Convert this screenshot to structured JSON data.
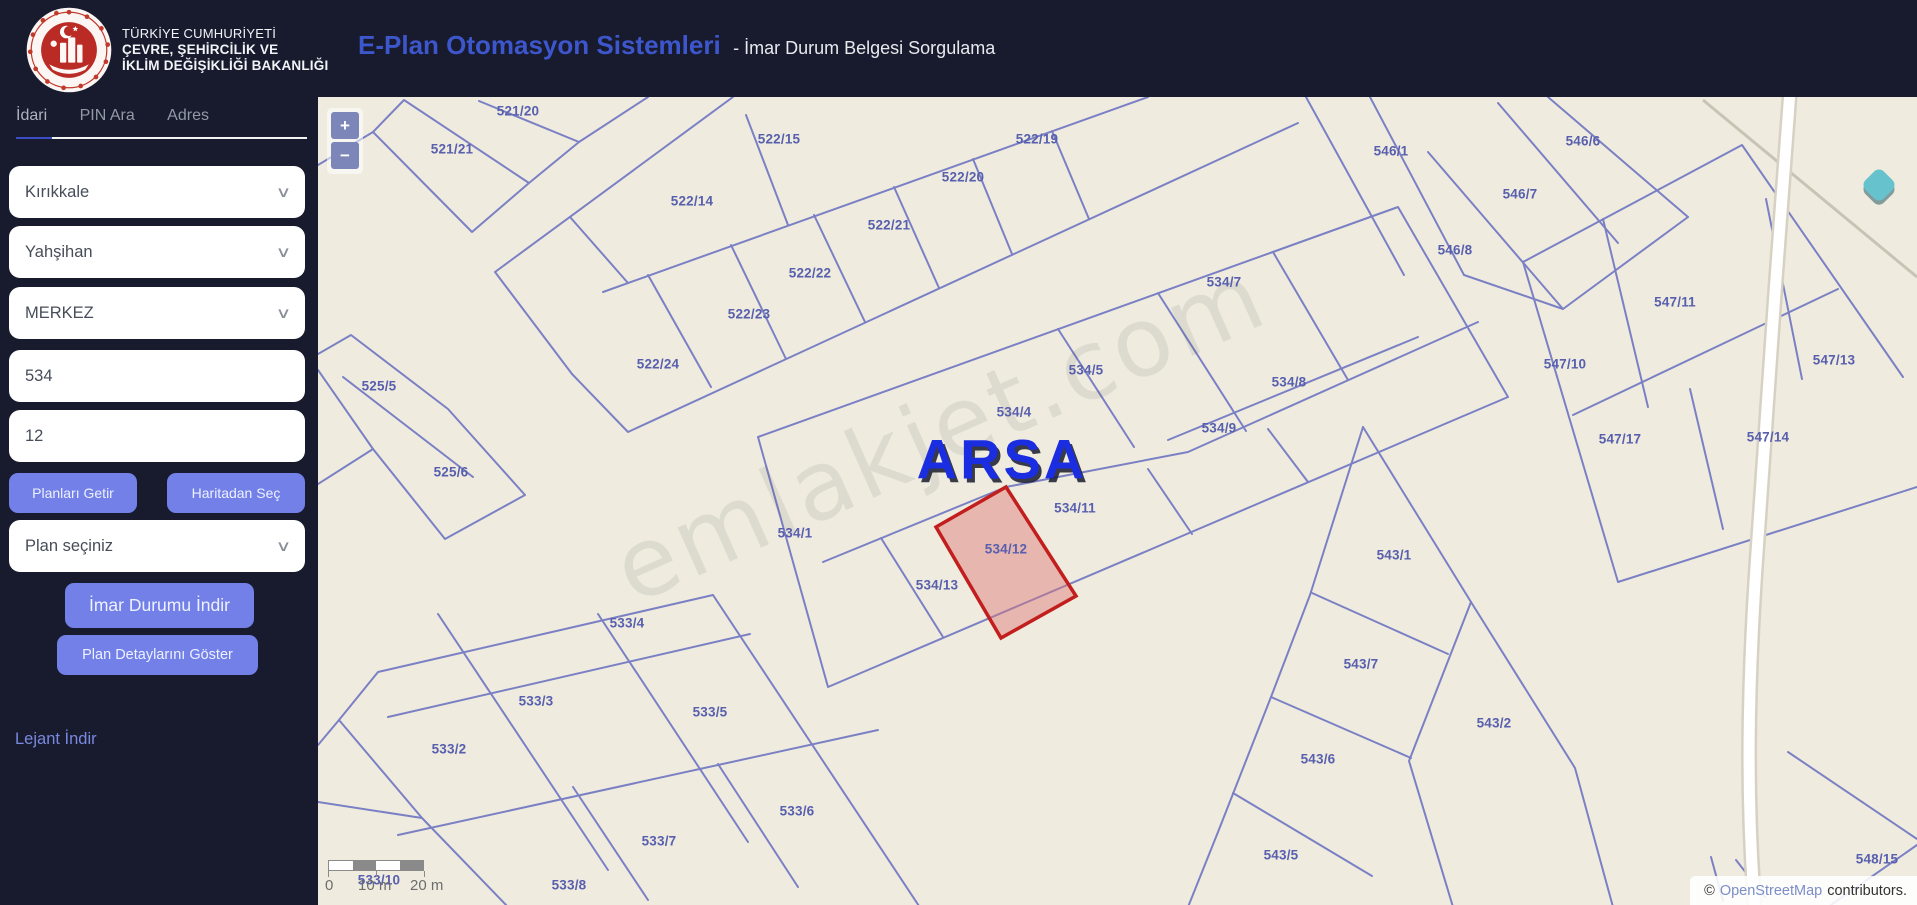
{
  "header": {
    "ministry_line1": "TÜRKİYE CUMHURİYETİ",
    "ministry_line2": "ÇEVRE, ŞEHİRCİLİK VE",
    "ministry_line3": "İKLİM DEĞİŞİKLİĞİ BAKANLIĞI",
    "app_title": "E-Plan Otomasyon Sistemleri",
    "app_subtitle": "- İmar Durum Belgesi Sorgulama"
  },
  "sidebar": {
    "tabs": [
      {
        "label": "İdari",
        "active": true
      },
      {
        "label": "PIN Ara",
        "active": false
      },
      {
        "label": "Adres",
        "active": false
      }
    ],
    "province_select": "Kırıkkale",
    "district_select": "Yahşihan",
    "neighborhood_select": "MERKEZ",
    "block_input": "534",
    "parcel_input": "12",
    "buttons": {
      "fetch_plans": "Planları Getir",
      "pick_from_map": "Haritadan Seç",
      "download_zoning": "İmar Durumu İndir",
      "show_plan_details": "Plan Detaylarını Göster"
    },
    "plan_select_placeholder": "Plan seçiniz",
    "legend_link": "Lejant İndir"
  },
  "map": {
    "controls": {
      "zoom_in": "+",
      "zoom_out": "−"
    },
    "highlight": {
      "parcel": "534/12",
      "overlay_label": "ARSA",
      "stroke": "#c21e1e",
      "fill": "rgba(221,118,118,0.45)"
    },
    "watermark": "emlakjet.com",
    "colors": {
      "background": "#efecdf",
      "parcel_line": "#7b80c5",
      "label": "#585fae",
      "marker": "#66c2cd"
    },
    "scale_bar": {
      "label_0": "0",
      "label_10": "10 m",
      "label_20": "20 m"
    },
    "attribution": {
      "prefix": "©",
      "link": "OpenStreetMap",
      "suffix": "contributors."
    },
    "parcels": [
      {
        "label": "521/20",
        "x": 200,
        "y": 14
      },
      {
        "label": "521/21",
        "x": 134,
        "y": 52
      },
      {
        "label": "522/15",
        "x": 461,
        "y": 42
      },
      {
        "label": "522/19",
        "x": 719,
        "y": 42
      },
      {
        "label": "546/1",
        "x": 1073,
        "y": 54
      },
      {
        "label": "546/6",
        "x": 1265,
        "y": 44
      },
      {
        "label": "522/14",
        "x": 374,
        "y": 104
      },
      {
        "label": "522/20",
        "x": 645,
        "y": 80
      },
      {
        "label": "546/7",
        "x": 1202,
        "y": 97
      },
      {
        "label": "522/21",
        "x": 571,
        "y": 128
      },
      {
        "label": "546/8",
        "x": 1137,
        "y": 153
      },
      {
        "label": "522/22",
        "x": 492,
        "y": 176
      },
      {
        "label": "534/7",
        "x": 906,
        "y": 185
      },
      {
        "label": "547/11",
        "x": 1357,
        "y": 205
      },
      {
        "label": "522/23",
        "x": 431,
        "y": 217
      },
      {
        "label": "547/10",
        "x": 1247,
        "y": 267
      },
      {
        "label": "547/13",
        "x": 1516,
        "y": 263
      },
      {
        "label": "522/24",
        "x": 340,
        "y": 267
      },
      {
        "label": "534/5",
        "x": 768,
        "y": 273
      },
      {
        "label": "525/5",
        "x": 61,
        "y": 289
      },
      {
        "label": "534/8",
        "x": 971,
        "y": 285
      },
      {
        "label": "534/4",
        "x": 696,
        "y": 315
      },
      {
        "label": "534/9",
        "x": 901,
        "y": 331
      },
      {
        "label": "547/17",
        "x": 1302,
        "y": 342
      },
      {
        "label": "547/14",
        "x": 1450,
        "y": 340
      },
      {
        "label": "525/6",
        "x": 133,
        "y": 375
      },
      {
        "label": "534/11",
        "x": 757,
        "y": 411
      },
      {
        "label": "534/1",
        "x": 477,
        "y": 436
      },
      {
        "label": "534/12",
        "x": 688,
        "y": 452
      },
      {
        "label": "543/1",
        "x": 1076,
        "y": 458
      },
      {
        "label": "534/13",
        "x": 619,
        "y": 488
      },
      {
        "label": "533/4",
        "x": 309,
        "y": 526
      },
      {
        "label": "543/7",
        "x": 1043,
        "y": 567
      },
      {
        "label": "533/3",
        "x": 218,
        "y": 604
      },
      {
        "label": "533/5",
        "x": 392,
        "y": 615
      },
      {
        "label": "543/2",
        "x": 1176,
        "y": 626
      },
      {
        "label": "533/2",
        "x": 131,
        "y": 652
      },
      {
        "label": "543/6",
        "x": 1000,
        "y": 662
      },
      {
        "label": "533/6",
        "x": 479,
        "y": 714
      },
      {
        "label": "533/7",
        "x": 341,
        "y": 744
      },
      {
        "label": "543/5",
        "x": 963,
        "y": 758
      },
      {
        "label": "548/15",
        "x": 1559,
        "y": 762
      },
      {
        "label": "533/8",
        "x": 251,
        "y": 788
      },
      {
        "label": "533/10",
        "x": 61,
        "y": 783
      }
    ]
  }
}
